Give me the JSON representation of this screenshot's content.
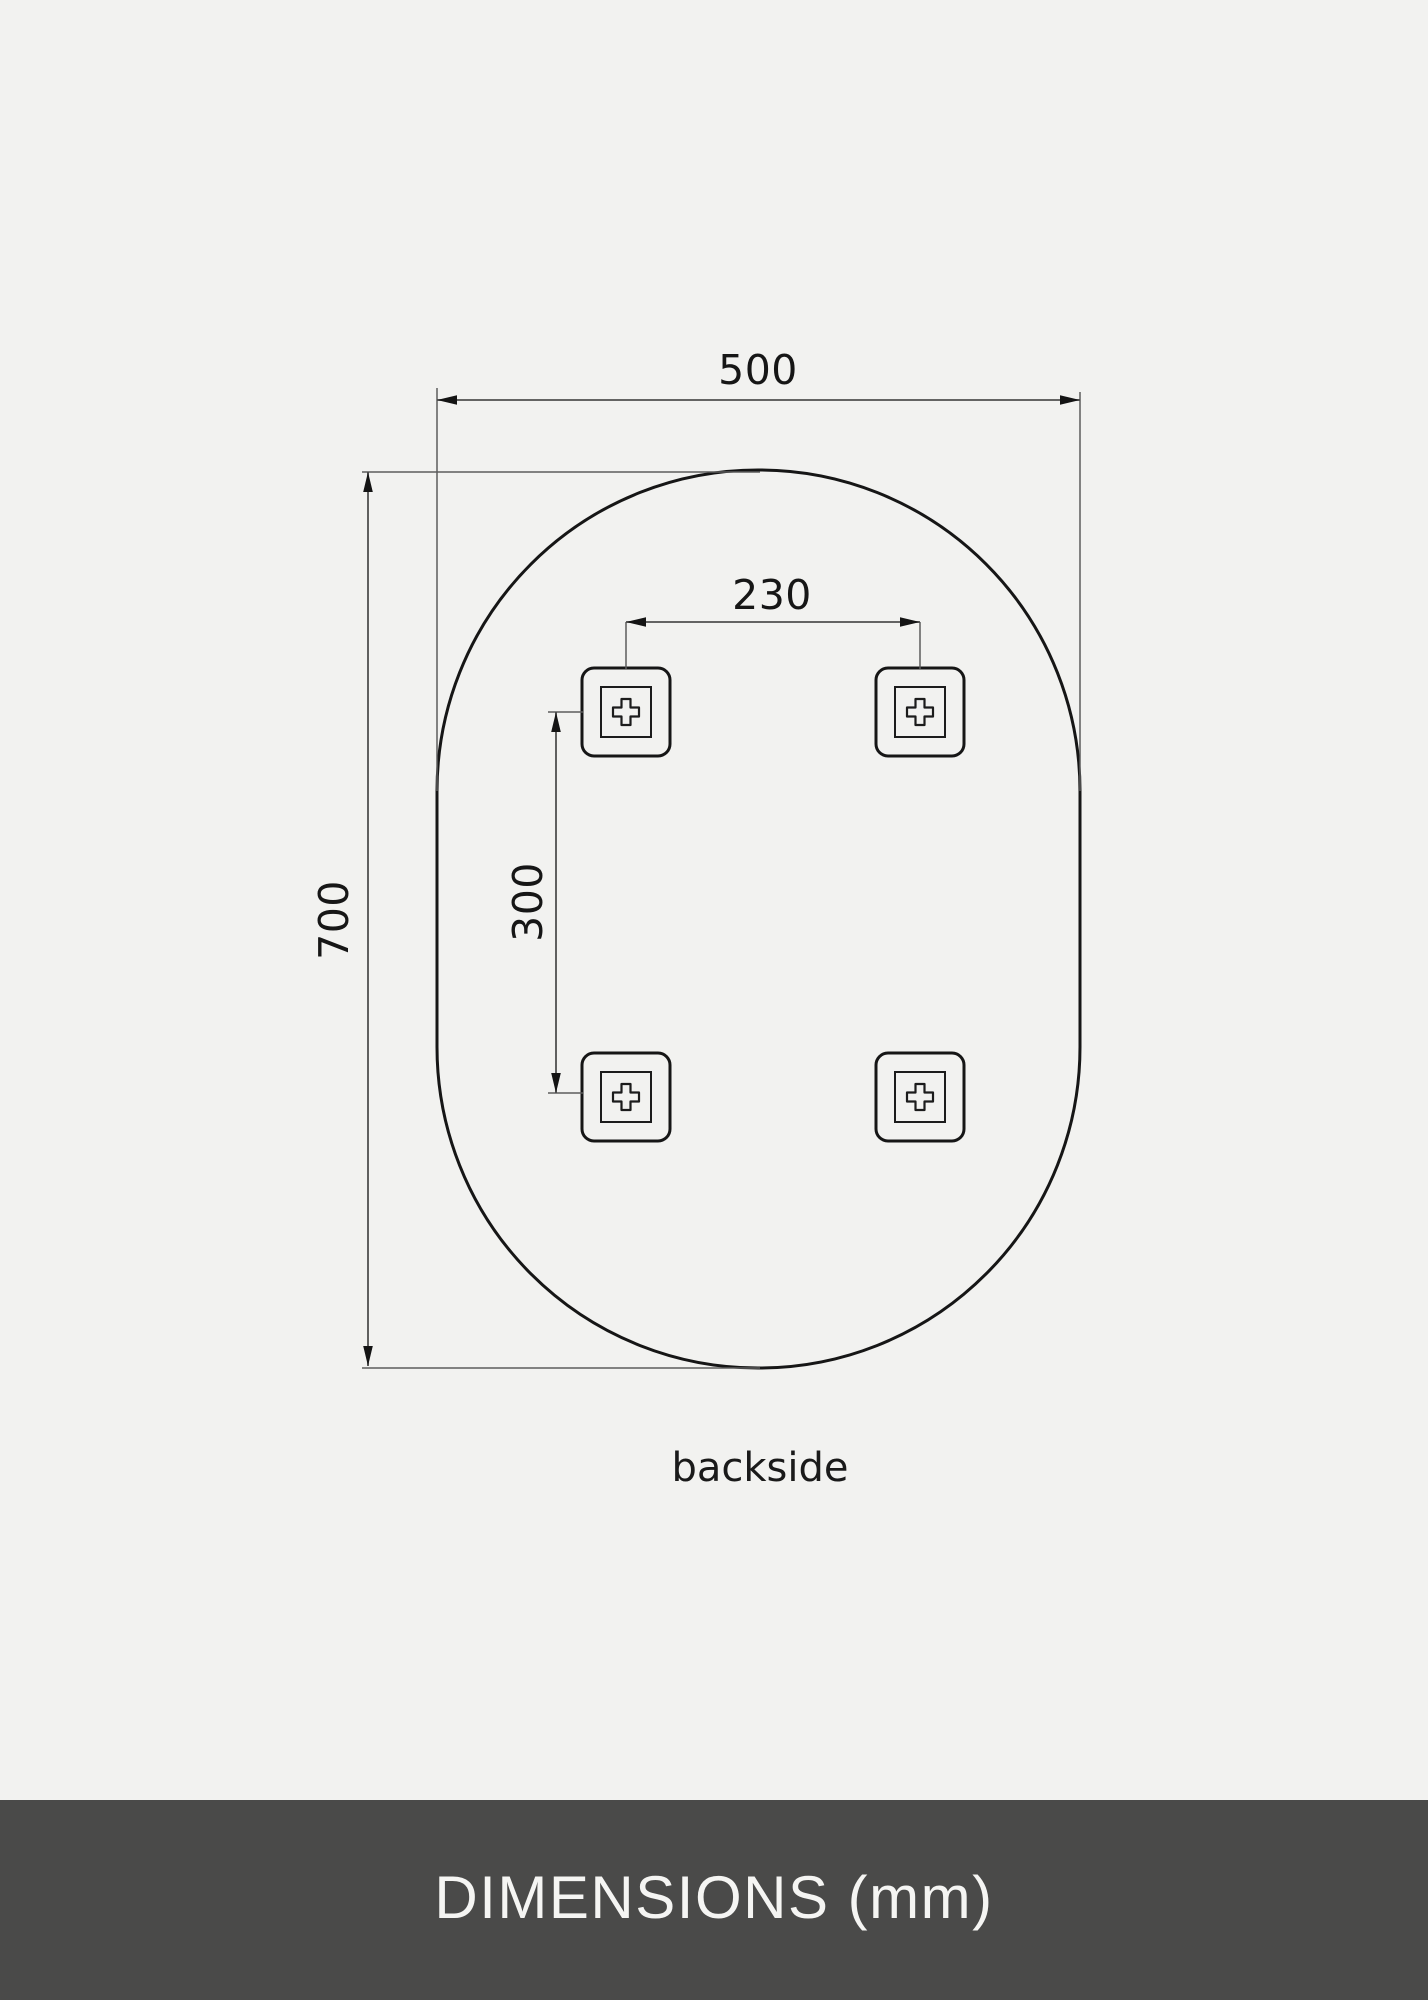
{
  "colors": {
    "canvas_background": "#f2f2f0",
    "outline_black": "#161616",
    "dimension_line_gray": "#4f4f4f",
    "footer_background": "#4a4a49",
    "footer_text": "#f5f5f3"
  },
  "diagram": {
    "dimension_width": "500",
    "dimension_height": "700",
    "bracket_spacing_horizontal": "230",
    "bracket_spacing_vertical": "300",
    "view_label": "backside",
    "bracket_count": 4
  },
  "footer": {
    "title": "DIMENSIONS (mm)"
  }
}
